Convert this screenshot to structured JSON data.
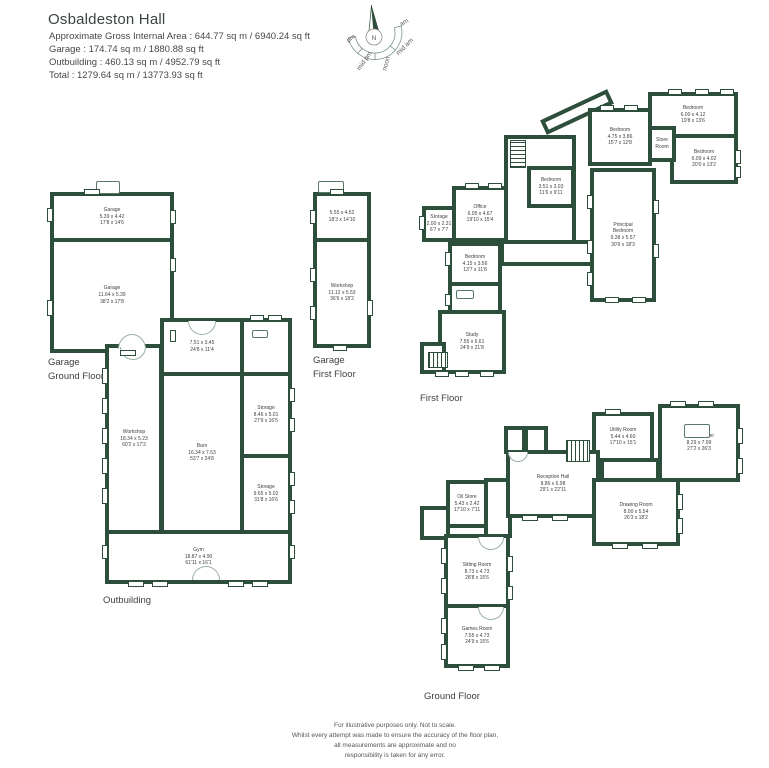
{
  "colors": {
    "wall": "#2d4e3b",
    "text": "#3f3f3f"
  },
  "header": {
    "title": "Osbaldeston Hall",
    "lines": [
      "Approximate Gross Internal Area : 644.77 sq m / 6940.24 sq ft",
      "Garage : 174.74 sq m / 1880.88 sq ft",
      "Outbuilding : 460.13 sq m / 4952.79 sq ft",
      "Total : 1279.64 sq m / 13773.93 sq ft"
    ]
  },
  "compass": {
    "north": "N",
    "labels": [
      {
        "text": "pm",
        "x": 22,
        "y": 40,
        "rot": -35
      },
      {
        "text": "mid pm",
        "x": 36,
        "y": 62,
        "rot": -55
      },
      {
        "text": "noon",
        "x": 58,
        "y": 64,
        "rot": -75
      },
      {
        "text": "mid am",
        "x": 76,
        "y": 48,
        "rot": -45
      },
      {
        "text": "am",
        "x": 75,
        "y": 24,
        "rot": -30
      }
    ]
  },
  "floors": [
    {
      "label": "Garage\nGround Floor",
      "label_pos": {
        "x": 48,
        "y": 356
      },
      "rooms": [
        {
          "id": "garage",
          "x": 50,
          "y": 192,
          "w": 124,
          "h": 50,
          "lines": [
            "Garage",
            "5.39 x 4.42",
            "17'8 x 14'6"
          ]
        },
        {
          "id": "garage",
          "x": 50,
          "y": 238,
          "w": 124,
          "h": 115,
          "lines": [
            "Garage",
            "11.64 x 5.39",
            "38'2 x 17'8"
          ]
        }
      ],
      "windows": [
        [
          47,
          208,
          6,
          14
        ],
        [
          47,
          300,
          6,
          16
        ],
        [
          170,
          210,
          6,
          14
        ],
        [
          170,
          258,
          6,
          14
        ],
        [
          170,
          330,
          6,
          12
        ],
        [
          84,
          189,
          16,
          6
        ],
        [
          120,
          350,
          16,
          6
        ]
      ],
      "arches": [
        {
          "x": 118,
          "y": 334,
          "w": 28,
          "h": 15,
          "flip": false
        }
      ],
      "stairs": [],
      "fixtures": [
        {
          "id": "chimney",
          "x": 96,
          "y": 181,
          "w": 24,
          "h": 13
        }
      ]
    },
    {
      "label": "Garage\nFirst Floor",
      "label_pos": {
        "x": 313,
        "y": 354
      },
      "rooms": [
        {
          "id": "loft-room",
          "x": 313,
          "y": 192,
          "w": 58,
          "h": 50,
          "lines": [
            "5.55 x 4.52",
            "18'3 x 14'10"
          ]
        },
        {
          "id": "workshop",
          "x": 313,
          "y": 238,
          "w": 58,
          "h": 110,
          "lines": [
            "Workshop",
            "11.12 x 5.53",
            "36'6 x 18'2"
          ]
        }
      ],
      "windows": [
        [
          310,
          210,
          6,
          14
        ],
        [
          310,
          268,
          6,
          14
        ],
        [
          310,
          306,
          6,
          14
        ],
        [
          367,
          300,
          6,
          16
        ],
        [
          330,
          189,
          14,
          6
        ],
        [
          333,
          345,
          14,
          6
        ]
      ],
      "arches": [],
      "stairs": [],
      "fixtures": [
        {
          "id": "chimney",
          "x": 318,
          "y": 181,
          "w": 26,
          "h": 12
        }
      ]
    },
    {
      "label": "Outbuilding",
      "label_pos": {
        "x": 103,
        "y": 594
      },
      "rooms": [
        {
          "id": "entrance-bay",
          "x": 160,
          "y": 318,
          "w": 84,
          "h": 58,
          "lines": [
            "7.51 x 3.45",
            "24'8 x 11'4"
          ]
        },
        {
          "id": "outbuilding-wc",
          "x": 240,
          "y": 318,
          "w": 52,
          "h": 58,
          "lines": []
        },
        {
          "id": "workshop",
          "x": 105,
          "y": 344,
          "w": 58,
          "h": 190,
          "lines": [
            "Workshop",
            "18.34 x 5.23",
            "60'2 x 17'2"
          ]
        },
        {
          "id": "barn",
          "x": 160,
          "y": 372,
          "w": 84,
          "h": 162,
          "lines": [
            "Barn",
            "16.34 x 7.53",
            "53'7 x 24'8"
          ]
        },
        {
          "id": "storage",
          "x": 240,
          "y": 372,
          "w": 52,
          "h": 86,
          "lines": [
            "Storage",
            "8.46 x 5.01",
            "27'9 x 16'5"
          ]
        },
        {
          "id": "storage",
          "x": 240,
          "y": 454,
          "w": 52,
          "h": 80,
          "lines": [
            "Storage",
            "9.65 x 5.02",
            "31'8 x 16'6"
          ]
        },
        {
          "id": "gym",
          "x": 105,
          "y": 530,
          "w": 187,
          "h": 54,
          "lines": [
            "Gym",
            "18.87 x 4.90",
            "61'11 x 16'1"
          ]
        }
      ],
      "windows": [
        [
          102,
          368,
          6,
          16
        ],
        [
          102,
          398,
          6,
          16
        ],
        [
          102,
          428,
          6,
          16
        ],
        [
          102,
          458,
          6,
          16
        ],
        [
          102,
          488,
          6,
          16
        ],
        [
          102,
          545,
          6,
          14
        ],
        [
          289,
          388,
          6,
          14
        ],
        [
          289,
          418,
          6,
          14
        ],
        [
          289,
          472,
          6,
          14
        ],
        [
          289,
          500,
          6,
          14
        ],
        [
          289,
          545,
          6,
          14
        ],
        [
          250,
          315,
          14,
          6
        ],
        [
          268,
          315,
          14,
          6
        ],
        [
          128,
          581,
          16,
          6
        ],
        [
          152,
          581,
          16,
          6
        ],
        [
          228,
          581,
          16,
          6
        ],
        [
          252,
          581,
          16,
          6
        ]
      ],
      "arches": [
        {
          "x": 120,
          "y": 347,
          "w": 26,
          "h": 13,
          "flip": true
        },
        {
          "x": 188,
          "y": 321,
          "w": 28,
          "h": 14,
          "flip": true
        },
        {
          "x": 192,
          "y": 566,
          "w": 28,
          "h": 14,
          "flip": false
        }
      ],
      "stairs": [],
      "fixtures": [
        {
          "id": "sink-icon",
          "x": 252,
          "y": 330,
          "w": 16,
          "h": 8
        }
      ]
    },
    {
      "label": "First Floor",
      "label_pos": {
        "x": 420,
        "y": 392
      },
      "rooms": [
        {
          "id": "landing-link",
          "x": 540,
          "y": 104,
          "w": 74,
          "h": 16,
          "rot": -25,
          "lines": []
        },
        {
          "id": "stair-hall",
          "x": 504,
          "y": 135,
          "w": 72,
          "h": 110,
          "lines": []
        },
        {
          "id": "corridor",
          "x": 500,
          "y": 240,
          "w": 96,
          "h": 26,
          "lines": []
        },
        {
          "id": "storage",
          "x": 422,
          "y": 206,
          "w": 34,
          "h": 36,
          "lines": [
            "Storage",
            "2.00 x 2.31",
            "6'7 x 7'7"
          ]
        },
        {
          "id": "office",
          "x": 452,
          "y": 186,
          "w": 56,
          "h": 56,
          "lines": [
            "Office",
            "6.05 x 4.67",
            "19'10 x 15'4"
          ]
        },
        {
          "id": "bedroom",
          "x": 448,
          "y": 242,
          "w": 54,
          "h": 44,
          "lines": [
            "Bedroom",
            "4.15 x 3.56",
            "13'7 x 11'8"
          ]
        },
        {
          "id": "bathroom",
          "x": 448,
          "y": 282,
          "w": 54,
          "h": 32,
          "lines": []
        },
        {
          "id": "study",
          "x": 438,
          "y": 310,
          "w": 68,
          "h": 64,
          "lines": [
            "Study",
            "7.55 x 6.61",
            "24'9 x 21'8"
          ]
        },
        {
          "id": "study-annex",
          "x": 420,
          "y": 342,
          "w": 26,
          "h": 32,
          "lines": []
        },
        {
          "id": "bedroom",
          "x": 588,
          "y": 108,
          "w": 64,
          "h": 58,
          "lines": [
            "Bedroom",
            "4.75 x 3.86",
            "15'7 x 12'8"
          ]
        },
        {
          "id": "bedroom",
          "x": 648,
          "y": 92,
          "w": 90,
          "h": 46,
          "lines": [
            "Bedroom",
            "6.00 x 4.12",
            "19'8 x 13'6"
          ]
        },
        {
          "id": "bedroom",
          "x": 670,
          "y": 134,
          "w": 68,
          "h": 50,
          "lines": [
            "Bedroom",
            "6.09 x 4.02",
            "20'0 x 13'2"
          ]
        },
        {
          "id": "principal-bedroom",
          "x": 590,
          "y": 168,
          "w": 66,
          "h": 134,
          "lines": [
            "Principal",
            "Bedroom",
            "9.38 x 5.57",
            "30'9 x 18'3"
          ]
        },
        {
          "id": "bedroom",
          "x": 527,
          "y": 166,
          "w": 48,
          "h": 42,
          "lines": [
            "Bedroom",
            "3.51 x 3.03",
            "11'6 x 9'11"
          ]
        },
        {
          "id": "store-room",
          "x": 648,
          "y": 126,
          "w": 28,
          "h": 36,
          "lines": [
            "Store",
            "Room"
          ]
        }
      ],
      "windows": [
        [
          465,
          183,
          14,
          6
        ],
        [
          488,
          183,
          14,
          6
        ],
        [
          419,
          216,
          6,
          14
        ],
        [
          445,
          252,
          6,
          14
        ],
        [
          445,
          294,
          6,
          12
        ],
        [
          435,
          371,
          14,
          6
        ],
        [
          455,
          371,
          14,
          6
        ],
        [
          480,
          371,
          14,
          6
        ],
        [
          600,
          105,
          14,
          6
        ],
        [
          624,
          105,
          14,
          6
        ],
        [
          668,
          89,
          14,
          6
        ],
        [
          695,
          89,
          14,
          6
        ],
        [
          720,
          89,
          14,
          6
        ],
        [
          735,
          150,
          6,
          14
        ],
        [
          735,
          166,
          6,
          12
        ],
        [
          587,
          195,
          6,
          14
        ],
        [
          587,
          240,
          6,
          14
        ],
        [
          587,
          272,
          6,
          14
        ],
        [
          653,
          200,
          6,
          14
        ],
        [
          653,
          244,
          6,
          14
        ],
        [
          605,
          297,
          14,
          6
        ],
        [
          632,
          297,
          14,
          6
        ]
      ],
      "arches": [],
      "stairs": [
        {
          "x": 510,
          "y": 140,
          "w": 16,
          "h": 28,
          "dir": "v"
        },
        {
          "x": 428,
          "y": 352,
          "w": 20,
          "h": 16,
          "dir": "h"
        }
      ],
      "fixtures": [
        {
          "id": "bathtub-icon",
          "x": 456,
          "y": 290,
          "w": 18,
          "h": 9
        }
      ]
    },
    {
      "label": "Ground Floor",
      "label_pos": {
        "x": 424,
        "y": 690
      },
      "rooms": [
        {
          "id": "inner-hall",
          "x": 600,
          "y": 458,
          "w": 60,
          "h": 24,
          "lines": []
        },
        {
          "id": "hallway",
          "x": 484,
          "y": 478,
          "w": 28,
          "h": 60,
          "lines": []
        },
        {
          "id": "porch",
          "x": 504,
          "y": 426,
          "w": 22,
          "h": 28,
          "lines": []
        },
        {
          "id": "porch",
          "x": 524,
          "y": 426,
          "w": 24,
          "h": 28,
          "lines": []
        },
        {
          "id": "utility-room",
          "x": 592,
          "y": 412,
          "w": 62,
          "h": 50,
          "lines": [
            "Utility Room",
            "5.44 x 4.60",
            "17'10 x 15'1"
          ]
        },
        {
          "id": "kitchen-diner",
          "x": 658,
          "y": 404,
          "w": 82,
          "h": 78,
          "lines": [
            "Kitchen/Diner",
            "8.29 x 7.99",
            "27'2 x 26'3"
          ]
        },
        {
          "id": "reception-hall",
          "x": 506,
          "y": 450,
          "w": 94,
          "h": 68,
          "lines": [
            "Reception Hall",
            "8.86 x 6.98",
            "29'1 x 22'11"
          ]
        },
        {
          "id": "drawing-room",
          "x": 592,
          "y": 478,
          "w": 88,
          "h": 68,
          "lines": [
            "Drawing Room",
            "8.00 x 5.54",
            "26'3 x 18'2"
          ]
        },
        {
          "id": "oil-store",
          "x": 446,
          "y": 480,
          "w": 42,
          "h": 48,
          "lines": [
            "Oil Store",
            "5.43 x 2.42",
            "17'10 x 7'11"
          ]
        },
        {
          "id": "store",
          "x": 420,
          "y": 506,
          "w": 30,
          "h": 34,
          "lines": []
        },
        {
          "id": "sitting-room",
          "x": 444,
          "y": 534,
          "w": 66,
          "h": 76,
          "lines": [
            "Sitting Room",
            "8.73 x 4.73",
            "28'8 x 15'6"
          ]
        },
        {
          "id": "games-room",
          "x": 444,
          "y": 604,
          "w": 66,
          "h": 64,
          "lines": [
            "Games Room",
            "7.55 x 4.73",
            "24'9 x 15'6"
          ]
        }
      ],
      "windows": [
        [
          605,
          409,
          16,
          6
        ],
        [
          670,
          401,
          16,
          6
        ],
        [
          698,
          401,
          16,
          6
        ],
        [
          737,
          428,
          6,
          16
        ],
        [
          737,
          458,
          6,
          16
        ],
        [
          677,
          494,
          6,
          16
        ],
        [
          677,
          518,
          6,
          16
        ],
        [
          612,
          543,
          16,
          6
        ],
        [
          642,
          543,
          16,
          6
        ],
        [
          522,
          515,
          16,
          6
        ],
        [
          552,
          515,
          16,
          6
        ],
        [
          441,
          548,
          6,
          16
        ],
        [
          441,
          578,
          6,
          16
        ],
        [
          441,
          618,
          6,
          16
        ],
        [
          441,
          644,
          6,
          16
        ],
        [
          458,
          665,
          16,
          6
        ],
        [
          484,
          665,
          16,
          6
        ],
        [
          507,
          556,
          6,
          16
        ],
        [
          507,
          586,
          6,
          14
        ]
      ],
      "arches": [
        {
          "x": 478,
          "y": 537,
          "w": 26,
          "h": 13,
          "flip": true
        },
        {
          "x": 478,
          "y": 607,
          "w": 26,
          "h": 13,
          "flip": true
        },
        {
          "x": 508,
          "y": 452,
          "w": 20,
          "h": 10,
          "flip": true
        }
      ],
      "stairs": [
        {
          "x": 566,
          "y": 440,
          "w": 24,
          "h": 22,
          "dir": "h"
        }
      ],
      "fixtures": [
        {
          "id": "kitchen-island",
          "x": 684,
          "y": 424,
          "w": 26,
          "h": 14
        }
      ]
    }
  ],
  "disclaimer": [
    "For illustrative purposes only. Not to scale.",
    "Whilst every attempt was made to ensure the accuracy of the floor plan,",
    "all measurements are approximate and no",
    "responsibility is taken for any error."
  ]
}
